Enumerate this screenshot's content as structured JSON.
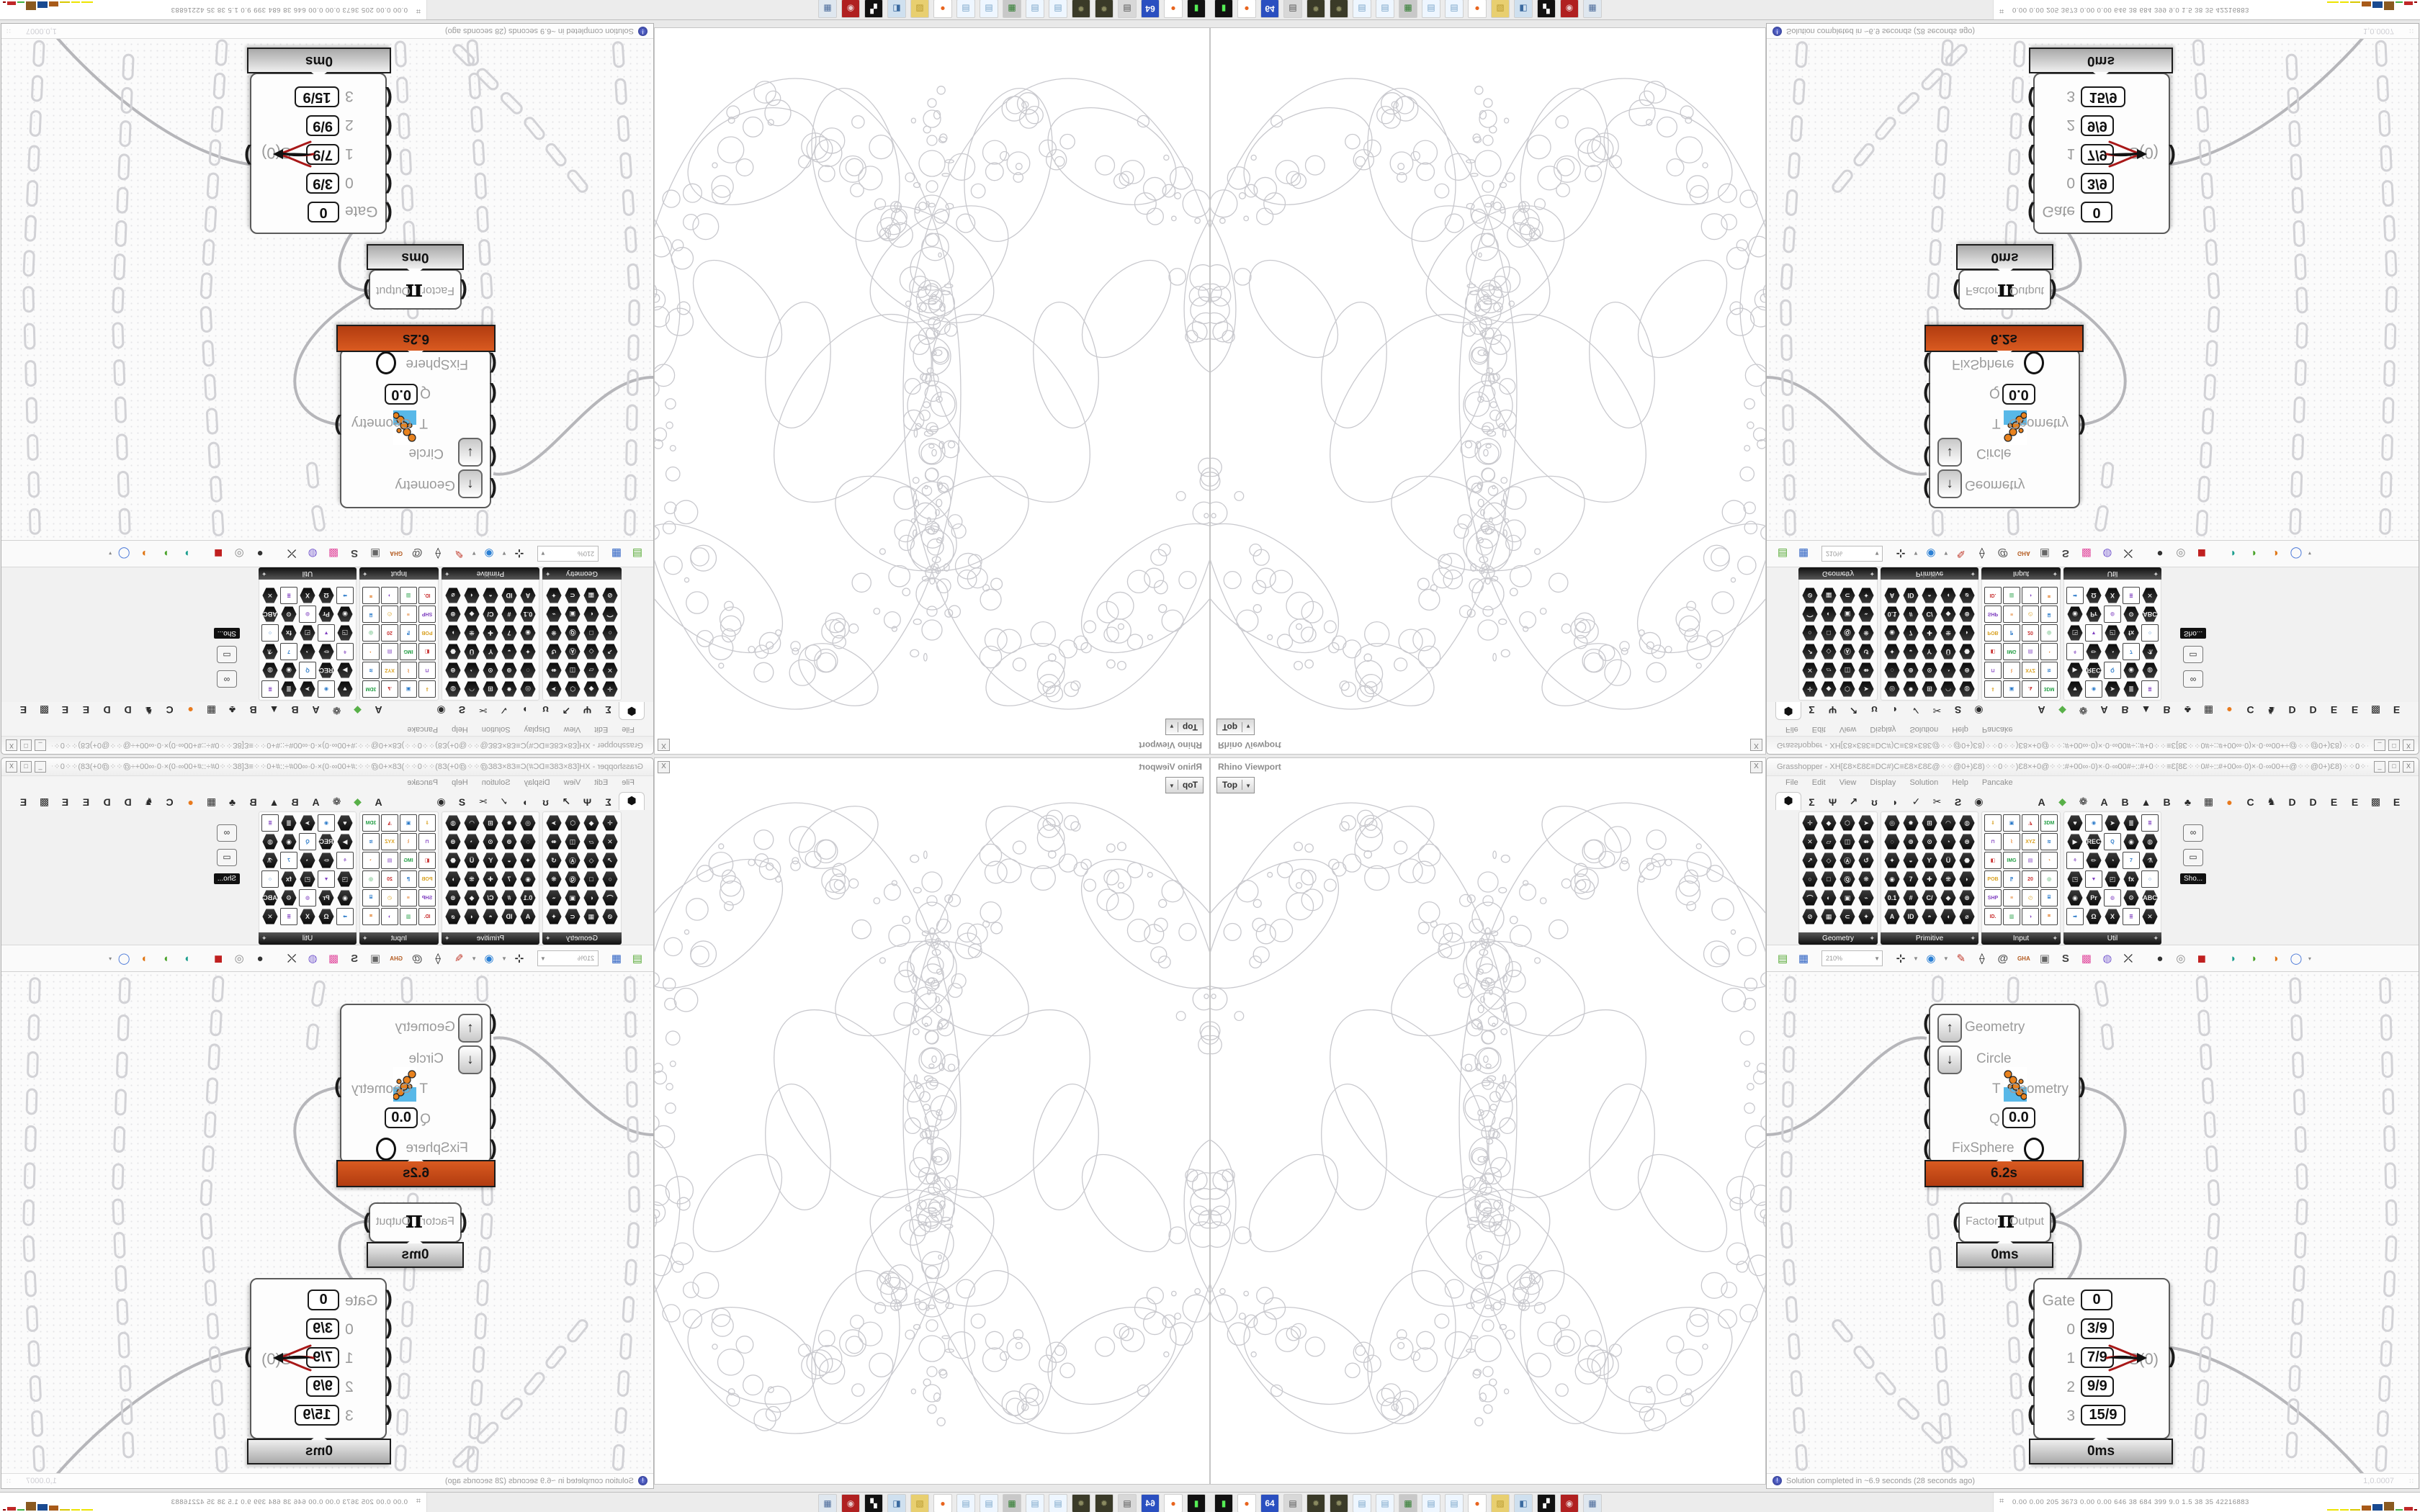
{
  "viewport": {
    "title": "Rhino Viewport",
    "close_label": "X",
    "view_button": "Top",
    "fractal_stroke": "#c9c9ce"
  },
  "gh_window": {
    "title": "Grasshopper - XH[Ɛ8×Ɛ8Ɛ≡DC#)C≡Ɛ8×Ɛ8Ɛ@⁘⁘@0+)Ɛ8)⁘⁘0⁘⁘)Ɛ8×+0@⁘⁘:#+00∞·0)×·0·∞00#÷::#+0⁘⁘≡Ɛ[8Ɛ⁘⁘0#÷::#+00∞·0)×·0·∞00+÷@⁘⁘@0+)Ɛ8)⁘⁘0⁘⁘...",
    "win_buttons": [
      "_",
      "□",
      "X"
    ],
    "menu_items": [
      "File",
      "Edit",
      "View",
      "Display",
      "Solution",
      "Help",
      "Pancake"
    ],
    "tab_active_glyph": "⬢",
    "tab_glyphs": [
      "Σ",
      "Ψ",
      "↗",
      "ʊ",
      "◗",
      "✓",
      "✂",
      "Ƨ",
      "◉",
      "|GAP|",
      "A",
      "◆",
      "❁",
      "A",
      "B",
      "▲",
      "B",
      "♣",
      "▦",
      "●",
      "C",
      "♞",
      "D",
      "D",
      "E",
      "E",
      "▩",
      "E"
    ],
    "tab_orange_glyph": "●",
    "tab_orange_color": "#e87a1e",
    "tab_green_glyph": "◆",
    "tab_green_color": "#58b048"
  },
  "ribbon": {
    "groups": [
      {
        "label": "Geometry",
        "cols": 4,
        "icons": [
          "✛",
          "◆",
          "⬡",
          "➤",
          "✕",
          "▱",
          "◫",
          "⇻",
          "↗",
          "◇",
          "Ⓐ",
          "↺",
          "○",
          "□",
          "Ⓠ",
          "❋",
          "⌒",
          "◐",
          "▣",
          "⌁",
          "⊘",
          "▦",
          "⊂",
          "✦"
        ]
      },
      {
        "label": "Primitive",
        "cols": 5,
        "icons": [
          "◎",
          "✸",
          "⊞",
          "◠",
          "◍",
          "◌",
          "⊕",
          "⊙",
          "◔",
          "⊛",
          "✦",
          "◒",
          "Ƴ",
          "Ü",
          "⬣",
          "◉",
          "7",
          "✚",
          "⁜",
          "◗",
          "0.1",
          "#",
          "C/",
          "◆",
          "⊗",
          "A",
          "ID",
          "◓",
          "◖",
          "⌀"
        ]
      },
      {
        "label": "Input",
        "cols": 4,
        "icons": [
          "⇓",
          "▣",
          "◮",
          "3DM",
          "⊓",
          "⌇",
          "XYZ",
          "≋",
          "◧",
          "IMG",
          "▤",
          "◔",
          "POB",
          "⁋",
          "20",
          "◎",
          "SHP",
          "≡",
          "◴",
          "⌸",
          "ID.",
          "▥",
          "◑",
          "⌗"
        ]
      },
      {
        "label": "Util",
        "cols": 5,
        "icons": [
          "♥",
          "◉",
          "➤",
          "≣",
          "≣",
          "▶",
          "REC",
          "Q",
          "◉",
          "◍",
          "⚘",
          "✏",
          "◔",
          "7",
          "⚗",
          "◳",
          "▼",
          "◰",
          "fx",
          "○",
          "◉",
          "Pr",
          "◍",
          "⚙",
          "ABC",
          "➡",
          "Ω",
          "X",
          "≣",
          "✕"
        ]
      }
    ],
    "extra_icon_names": [
      "eyeglasses-icon",
      "projector-screen-icon"
    ],
    "extra_icon_glyphs": [
      "∞",
      "▭"
    ],
    "overflow_tooltip": "Sho..."
  },
  "canvas_toolbar": {
    "zoom_value": "210%",
    "icons": [
      {
        "name": "open-file-icon",
        "g": "▤",
        "c": "#56a934"
      },
      {
        "name": "save-file-icon",
        "g": "▦",
        "c": "#2f63c4"
      },
      {
        "name": "zoom-extents-icon",
        "g": "⊹",
        "c": "#222222"
      },
      {
        "name": "preview-eye-icon",
        "g": "◉",
        "c": "#2a7fd4"
      },
      {
        "name": "sketch-pen-icon",
        "g": "✎",
        "c": "#c0392b"
      },
      {
        "name": "exposure-icon",
        "g": "⟠",
        "c": "#222222"
      },
      {
        "name": "publish-icon",
        "g": "@",
        "c": "#555555"
      },
      {
        "name": "gha-icon",
        "g": "GHA",
        "c": "#b35a1f"
      },
      {
        "name": "script-editor-icon",
        "g": "▣",
        "c": "#666666"
      },
      {
        "name": "finder-icon",
        "g": "S",
        "c": "#444444"
      },
      {
        "name": "gift-icon",
        "g": "▩",
        "c": "#e24fa0"
      },
      {
        "name": "galapagos-icon",
        "g": "◍",
        "c": "#7a5fd0"
      },
      {
        "name": "wires-icon",
        "g": "⤫",
        "c": "#333333"
      },
      {
        "name": "mesh-sphere-icon",
        "g": "●",
        "c": "#333333"
      },
      {
        "name": "mesh-torus-icon",
        "g": "◎",
        "c": "#8a8a8a"
      },
      {
        "name": "box-display-icon",
        "g": "◼",
        "c": "#c02020"
      },
      {
        "name": "lens-teal-icon",
        "g": "◗",
        "c": "#1c9e8e"
      },
      {
        "name": "lens-green-icon",
        "g": "◗",
        "c": "#4aa32a"
      },
      {
        "name": "lens-orange-icon",
        "g": "◑",
        "c": "#e07818"
      },
      {
        "name": "lens-blue-icon",
        "g": "◯",
        "c": "#4a78d8"
      }
    ]
  },
  "components": {
    "apollonian": {
      "inputs": [
        {
          "label": "Geometry",
          "button": "↑"
        },
        {
          "label": "Circle",
          "button": "↓"
        },
        {
          "label": "T"
        },
        {
          "label": "Q",
          "value": "0.0"
        },
        {
          "label": "FixSphere",
          "toggle": true
        }
      ],
      "output": "Geometry",
      "time": "6.2s",
      "time_color": "#c8481e"
    },
    "pi": {
      "input": "Factor",
      "glyph": "π",
      "output": "Output",
      "time": "0ms"
    },
    "gate": {
      "rows": [
        {
          "label": "Gate",
          "value": "0"
        },
        {
          "label": "0",
          "value": "3/9"
        },
        {
          "label": "1",
          "value": "7/9"
        },
        {
          "label": "2",
          "value": "9/9"
        },
        {
          "label": "3",
          "value": "15/9"
        }
      ],
      "output": "S(0)",
      "time": "0ms"
    }
  },
  "status_bar": {
    "message": "Solution completed in ~6.9 seconds (28 seconds ago)",
    "version": "1,0.0007"
  },
  "taskbar": {
    "icons": [
      {
        "name": "terminal-icon",
        "g": "▮",
        "bg": "#111111",
        "fg": "#55ee55"
      },
      {
        "name": "firefox-icon",
        "g": "●",
        "bg": "#ffffff",
        "fg": "#e8641e"
      },
      {
        "name": "floppy-64-icon",
        "g": "64",
        "bg": "#2a4fc0",
        "fg": "#ffffff"
      },
      {
        "name": "document-icon",
        "g": "▤",
        "bg": "#d8d8d8",
        "fg": "#555555"
      },
      {
        "name": "dark-app-icon",
        "g": "✹",
        "bg": "#3a3a28",
        "fg": "#8a8a60"
      },
      {
        "name": "dark-app-icon-2",
        "g": "✹",
        "bg": "#3a3a28",
        "fg": "#8a8a60"
      },
      {
        "name": "notepad-icon",
        "g": "▤",
        "bg": "#eef6ff",
        "fg": "#7aa5c8"
      },
      {
        "name": "notepad-icon-2",
        "g": "▤",
        "bg": "#eef6ff",
        "fg": "#7aa5c8"
      },
      {
        "name": "display-icon",
        "g": "▦",
        "bg": "#c8c8c8",
        "fg": "#2a7a2a"
      },
      {
        "name": "notepad-icon-3",
        "g": "▤",
        "bg": "#eef6ff",
        "fg": "#7aa5c8"
      },
      {
        "name": "notepad-icon-4",
        "g": "▤",
        "bg": "#eef6ff",
        "fg": "#7aa5c8"
      },
      {
        "name": "firefox-icon-2",
        "g": "●",
        "bg": "#ffffff",
        "fg": "#e8641e"
      },
      {
        "name": "folder-icon",
        "g": "▨",
        "bg": "#e8cf70",
        "fg": "#b89a30"
      },
      {
        "name": "media-icon",
        "g": "◧",
        "bg": "#cfe0ef",
        "fg": "#3a6aa0"
      },
      {
        "name": "photo-negative-icon",
        "g": "▞",
        "bg": "#111111",
        "fg": "#ffffff"
      },
      {
        "name": "red-emblem-icon",
        "g": "◉",
        "bg": "#b02020",
        "fg": "#e8c8c8"
      },
      {
        "name": "calculator-icon",
        "g": "▦",
        "bg": "#dfe7ef",
        "fg": "#4a6a9a"
      }
    ],
    "monitor_glyph": "⌗",
    "monitor_values": "0.00 0.00  205  3673 0.00 0.00  646   38   684   399   9.0   1.5   38   35  42216883",
    "monitor_bars": [
      {
        "c": "#ede400",
        "w": 16,
        "h": 2
      },
      {
        "c": "#ede400",
        "w": 12,
        "h": 2
      },
      {
        "c": "#d8c800",
        "w": 14,
        "h": 2
      },
      {
        "c": "#a85a18",
        "w": 13,
        "h": 7
      },
      {
        "c": "#1a4a90",
        "w": 14,
        "h": 9
      },
      {
        "c": "#8a5a20",
        "w": 14,
        "h": 12
      },
      {
        "c": "#40b040",
        "w": 10,
        "h": 2
      },
      {
        "c": "#c02828",
        "w": 12,
        "h": 5
      },
      {
        "c": "#900000",
        "w": 4,
        "h": 2
      }
    ]
  }
}
